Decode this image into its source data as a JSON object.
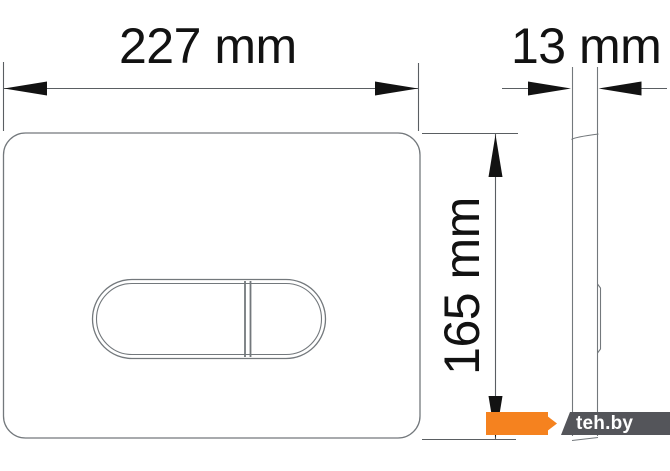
{
  "dimensions": {
    "width_label": "227 mm",
    "depth_label": "13 mm",
    "height_label": "165 mm"
  },
  "watermark": {
    "label": "teh.by",
    "orange": "#F5821F",
    "gray": "#54555A",
    "text_color": "#ffffff"
  },
  "colors": {
    "background": "#ffffff",
    "outline": "#73787c",
    "dimension": "#5a5e62",
    "ink": "#121212"
  }
}
